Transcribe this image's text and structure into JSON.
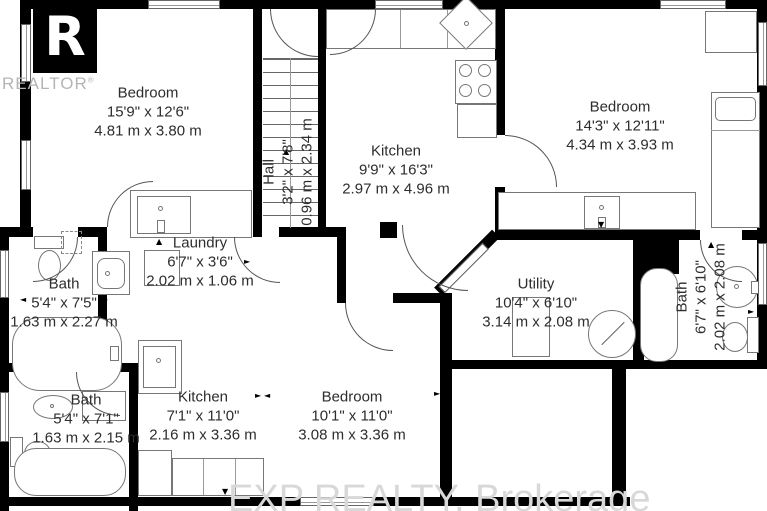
{
  "branding": {
    "logo_letter": "R",
    "logo_text": "REALTOR",
    "registered_mark": "®",
    "watermark": "EXP REALTY, Brokerage"
  },
  "rooms": [
    {
      "id": "bedroom-top-left",
      "name": "Bedroom",
      "dim_ft": "15'9\" x 12'6\"",
      "dim_m": "4.81 m x 3.80 m"
    },
    {
      "id": "kitchen-main",
      "name": "Kitchen",
      "dim_ft": "9'9\" x 16'3\"",
      "dim_m": "2.97 m x 4.96 m"
    },
    {
      "id": "bedroom-top-right",
      "name": "Bedroom",
      "dim_ft": "14'3\" x 12'11\"",
      "dim_m": "4.34 m x 3.93 m"
    },
    {
      "id": "hall",
      "name": "Hall",
      "dim_ft": "3'2\" x 7'8\"",
      "dim_m": "0.96 m x 2.34 m"
    },
    {
      "id": "laundry",
      "name": "Laundry",
      "dim_ft": "6'7\" x 3'6\"",
      "dim_m": "2.02 m x 1.06 m"
    },
    {
      "id": "bath-left",
      "name": "Bath",
      "dim_ft": "5'4\" x 7'5\"",
      "dim_m": "1.63 m x 2.27 m"
    },
    {
      "id": "utility",
      "name": "Utility",
      "dim_ft": "10'4\" x 6'10\"",
      "dim_m": "3.14 m x 2.08 m"
    },
    {
      "id": "bath-right",
      "name": "Bath",
      "dim_ft": "6'7\" x 6'10\"",
      "dim_m": "2.02 m x 2.08 m"
    },
    {
      "id": "kitchen-lower",
      "name": "Kitchen",
      "dim_ft": "7'1\" x 11'0\"",
      "dim_m": "2.16 m x 3.36 m"
    },
    {
      "id": "bedroom-lower",
      "name": "Bedroom",
      "dim_ft": "10'1\" x 11'0\"",
      "dim_m": "3.08 m x 3.36 m"
    },
    {
      "id": "bath-lower-left",
      "name": "Bath",
      "dim_ft": "5'4\" x 7'1\"",
      "dim_m": "1.63 m x 2.15 m"
    }
  ],
  "glyphs": {
    "up": "▲",
    "down": "▼",
    "left": "◄",
    "right": "►"
  },
  "colors": {
    "wall": "#000000",
    "fixture_line": "#777777",
    "label_text": "#2d2d2d",
    "watermark": "#d8d8d8",
    "logo_gray": "#b5b5b5"
  }
}
